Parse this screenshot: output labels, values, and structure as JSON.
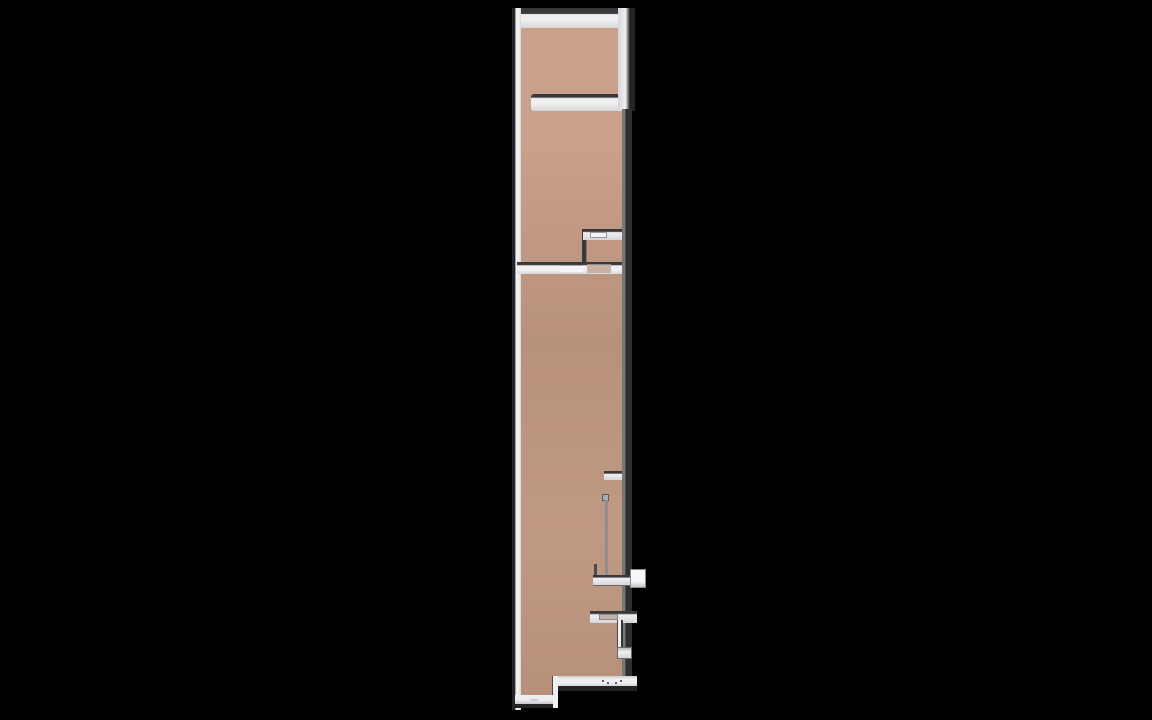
{
  "scene": {
    "description": "Top-down 3D rendered floor plan of a long narrow unit on a black background",
    "view": "orthographic-top"
  },
  "colors": {
    "background": "#000000",
    "floor-top": "#c9a089",
    "floor-mid": "#b8917c",
    "floor-low": "#c09982",
    "wall-white": "#f0f0f2",
    "wall-white-dim": "#d6d6da",
    "wall-dark-edge": "#39393b",
    "wall-outer-dark": "#242426",
    "glass-dark": "#2f2f31",
    "glass-lip": "#77777a",
    "railing-gray": "#8f8f92",
    "opening-tan": "#c9b2a3",
    "threshold-white": "#f6f6f8",
    "dot-gray": "#5f5f63"
  },
  "plan": {
    "elements": [
      "exterior-walls",
      "upper-room",
      "interior-partition-wall",
      "small-corner-room",
      "full-width-divider-wall-with-doorways",
      "long-lower-room",
      "wall-stub",
      "stair-railing",
      "balcony-enclosure",
      "exterior-ledge",
      "bottom-entry-threshold"
    ]
  }
}
